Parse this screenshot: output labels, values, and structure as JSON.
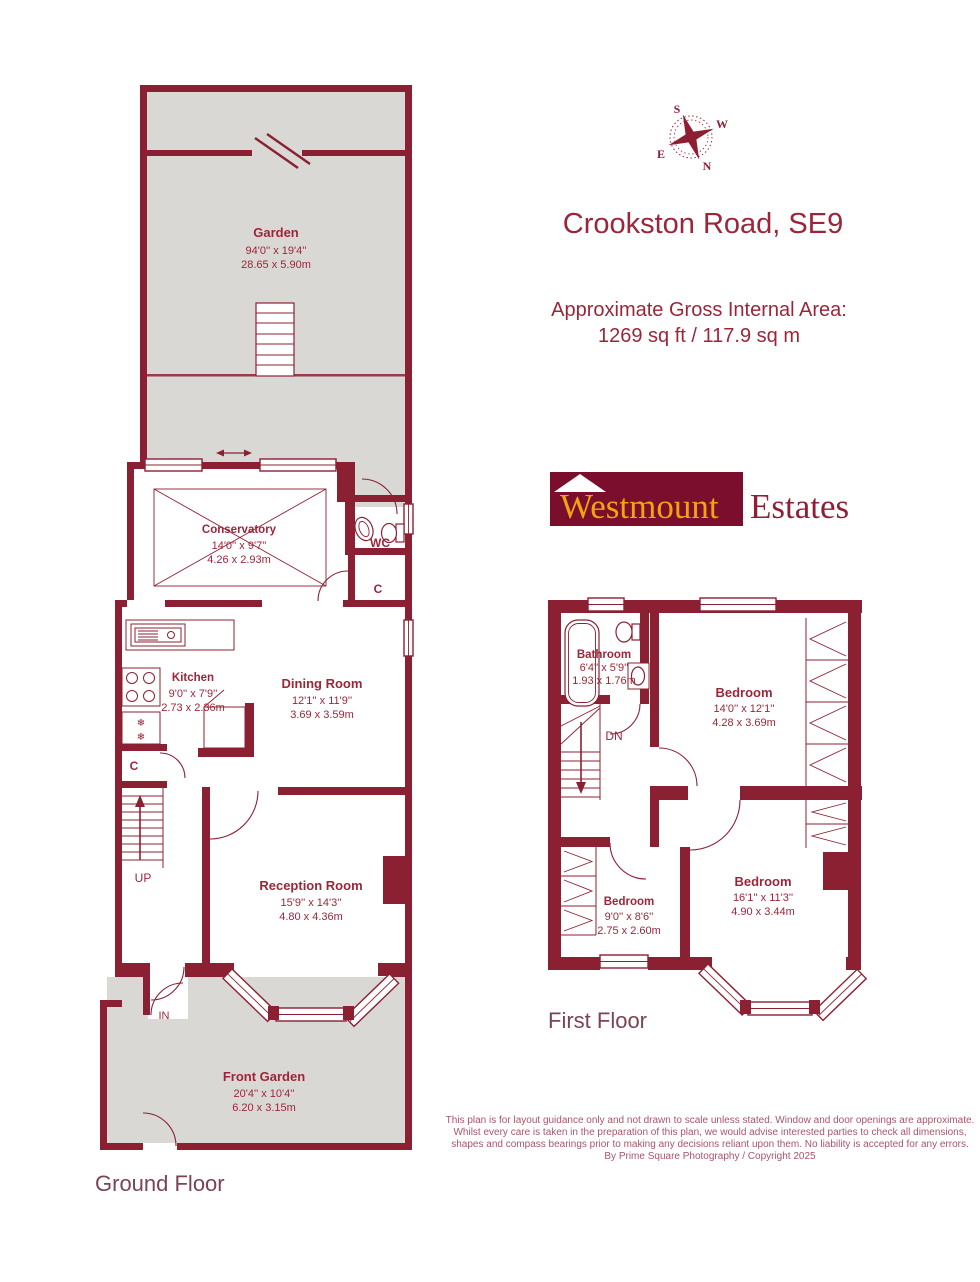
{
  "header": {
    "title": "Crookston Road, SE9",
    "area_heading": "Approximate Gross Internal Area:",
    "area_value": "1269 sq ft / 117.9 sq m"
  },
  "compass": {
    "n": "N",
    "s": "S",
    "e": "E",
    "w": "W"
  },
  "logo": {
    "brand": "Westmount",
    "suffix": "Estates"
  },
  "floors": {
    "ground_label": "Ground Floor",
    "first_label": "First Floor"
  },
  "rooms": {
    "garden": {
      "name": "Garden",
      "imperial": "94'0'' x 19'4''",
      "metric": "28.65 x 5.90m"
    },
    "conservatory": {
      "name": "Conservatory",
      "imperial": "14'0'' x 9'7''",
      "metric": "4.26 x 2.93m"
    },
    "wc": {
      "name": "WC"
    },
    "cupboard_right": {
      "name": "C"
    },
    "kitchen": {
      "name": "Kitchen",
      "imperial": "9'0'' x 7'9''",
      "metric": "2.73 x 2.36m"
    },
    "dining": {
      "name": "Dining Room",
      "imperial": "12'1'' x 11'9''",
      "metric": "3.69 x 3.59m"
    },
    "cupboard_hall": {
      "name": "C"
    },
    "reception": {
      "name": "Reception Room",
      "imperial": "15'9'' x 14'3''",
      "metric": "4.80 x 4.36m"
    },
    "front_garden": {
      "name": "Front Garden",
      "imperial": "20'4'' x 10'4''",
      "metric": "6.20 x 3.15m"
    },
    "bathroom": {
      "name": "Bathroom",
      "imperial": "6'4'' x 5'9''",
      "metric": "1.93 x 1.76m"
    },
    "bedroom1": {
      "name": "Bedroom",
      "imperial": "14'0'' x 12'1''",
      "metric": "4.28 x 3.69m"
    },
    "bedroom2": {
      "name": "Bedroom",
      "imperial": "9'0'' x 8'6''",
      "metric": "2.75 x 2.60m"
    },
    "bedroom3": {
      "name": "Bedroom",
      "imperial": "16'1'' x 11'3''",
      "metric": "4.90 x 3.44m"
    }
  },
  "annotations": {
    "up": "UP",
    "dn": "DN",
    "in": "IN",
    "snowflake": "❄"
  },
  "disclaimer": {
    "lines": [
      "This plan is for layout guidance only and not drawn to scale unless stated. Window and door openings are approximate.",
      "Whilst every care is taken in the preparation of this plan, we would advise interested parties to check all dimensions,",
      "shapes and compass bearings prior to making any decisions reliant upon them. No liability is accepted for any errors.",
      "By Prime Square Photography / Copyright 2025"
    ]
  },
  "colors": {
    "wall": "#8C2033",
    "garden_gray": "#D9D8D5",
    "label_text": "#9C2639",
    "logo_bg": "#7B0E2D",
    "logo_gold": "#EFA50E",
    "disclaimer_text": "#A8566A"
  }
}
